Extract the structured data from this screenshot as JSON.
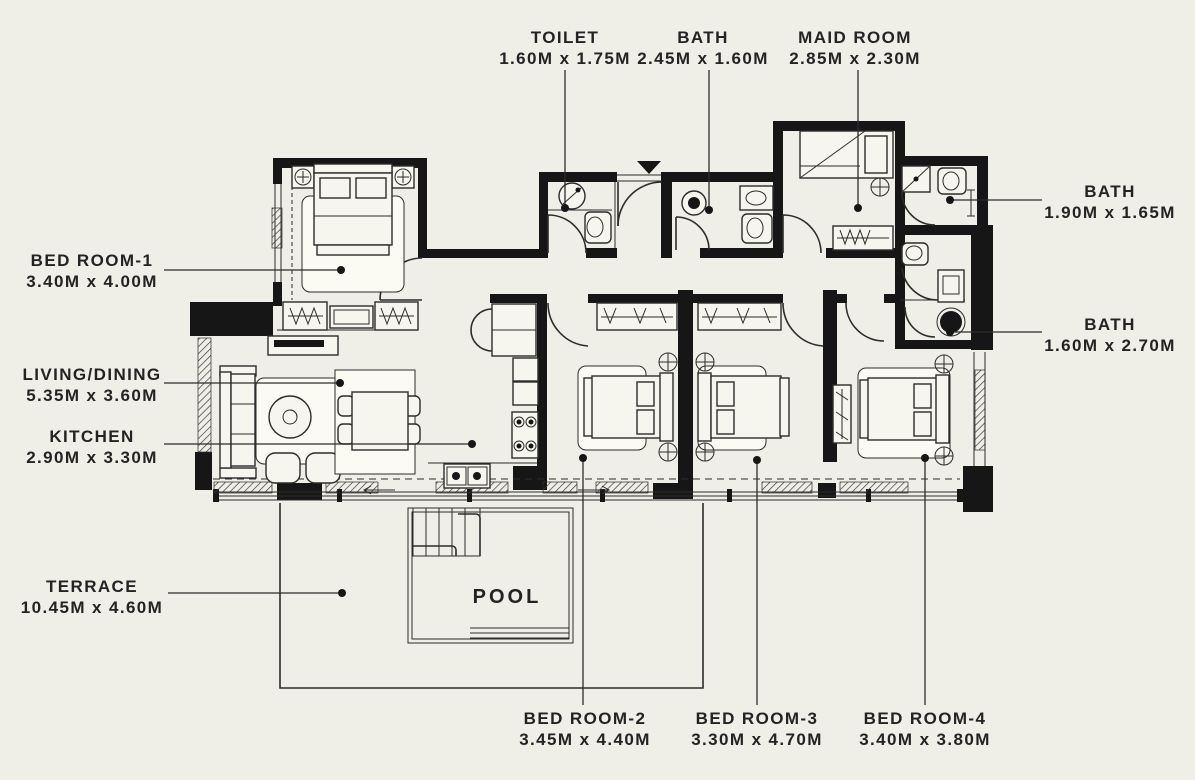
{
  "palette": {
    "background": "#efeee7",
    "ink": "#161616",
    "line": "#2c2c2c",
    "furniture_fill": "#f6f5ee",
    "paper": "#fbfaf3"
  },
  "plan": {
    "pool_label": "POOL",
    "labels": [
      {
        "id": "toilet",
        "name": "TOILET",
        "dims": "1.60M x 1.75M"
      },
      {
        "id": "bath-top",
        "name": "BATH",
        "dims": "2.45M x 1.60M"
      },
      {
        "id": "maid-room",
        "name": "MAID ROOM",
        "dims": "2.85M x 2.30M"
      },
      {
        "id": "bath-right-upper",
        "name": "BATH",
        "dims": "1.90M x 1.65M"
      },
      {
        "id": "bath-right-lower",
        "name": "BATH",
        "dims": "1.60M x 2.70M"
      },
      {
        "id": "bed-room-1",
        "name": "BED ROOM-1",
        "dims": "3.40M x 4.00M"
      },
      {
        "id": "living-dining",
        "name": "LIVING/DINING",
        "dims": "5.35M x 3.60M"
      },
      {
        "id": "kitchen",
        "name": "KITCHEN",
        "dims": "2.90M x 3.30M"
      },
      {
        "id": "terrace",
        "name": "TERRACE",
        "dims": "10.45M x 4.60M"
      },
      {
        "id": "bed-room-2",
        "name": "BED ROOM-2",
        "dims": "3.45M x 4.40M"
      },
      {
        "id": "bed-room-3",
        "name": "BED ROOM-3",
        "dims": "3.30M x 4.70M"
      },
      {
        "id": "bed-room-4",
        "name": "BED ROOM-4",
        "dims": "3.40M x 3.80M"
      }
    ]
  }
}
